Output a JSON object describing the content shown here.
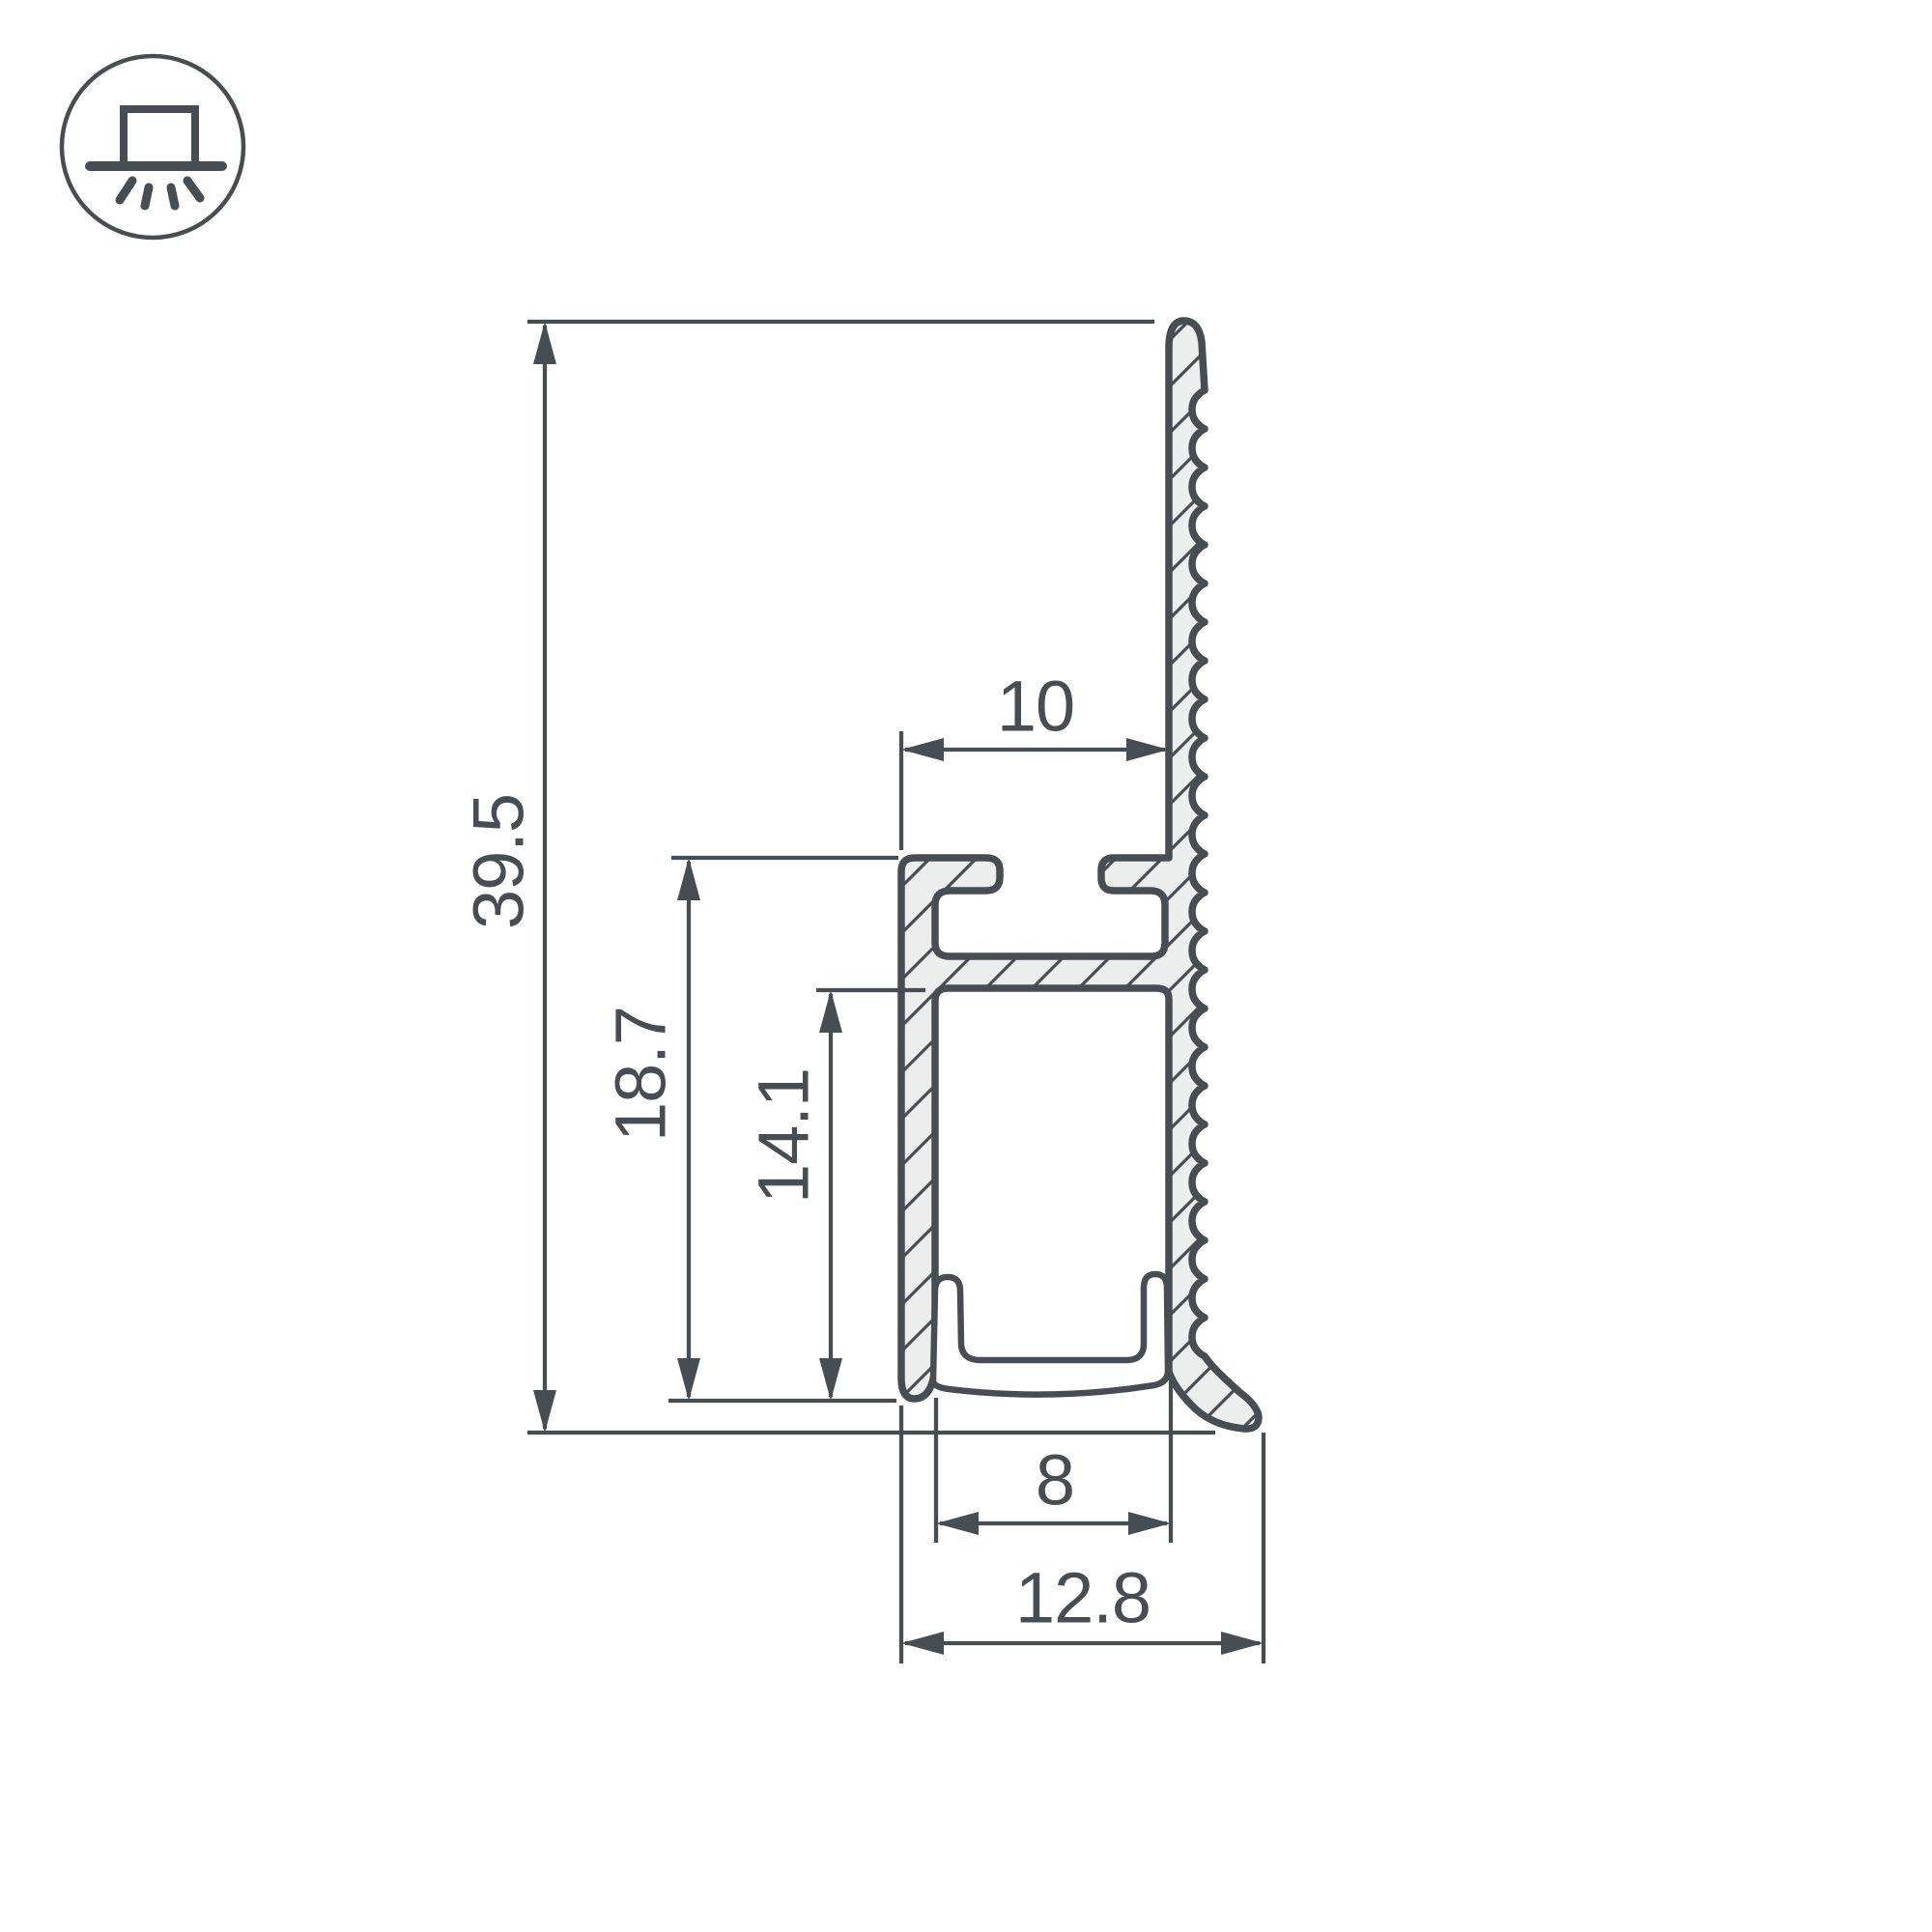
{
  "icon": {
    "name": "surface-mounted-light-icon"
  },
  "dimensions": {
    "total_height": "39.5",
    "flange_height": "18.7",
    "channel_height": "14.1",
    "flange_width": "10",
    "channel_width": "8",
    "total_width": "12.8"
  },
  "colors": {
    "line": "#474E53",
    "section_fill": "#ECEDED",
    "background": "#FFFFFF"
  }
}
